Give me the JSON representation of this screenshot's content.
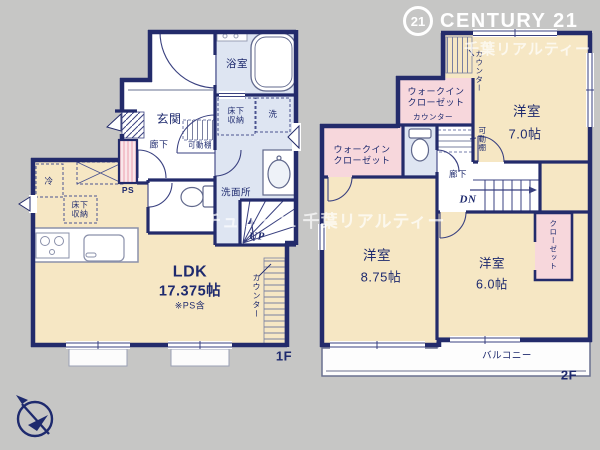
{
  "branding": {
    "badge": "21",
    "name": "CENTURY 21",
    "watermark_top": "千葉リアルティー",
    "watermark_center": "センチュリー21 千葉リアルティー"
  },
  "floor1": {
    "label": "1F",
    "ldk": {
      "name": "LDK",
      "size": "17.375帖",
      "note": "※PS含"
    },
    "genkan": "玄関",
    "bath": "浴室",
    "washroom": "洗面所",
    "corridor": "廊下",
    "movable_shelf": "可動棚",
    "storage_hall": "床下収納",
    "storage_ldk": "床下収納",
    "laundry": "洗",
    "fridge": "冷",
    "ps": "PS",
    "counter": "カウンター",
    "stairs_up": "UP"
  },
  "floor2": {
    "label": "2F",
    "room7": {
      "name": "洋室",
      "size": "7.0帖"
    },
    "room875": {
      "name": "洋室",
      "size": "8.75帖"
    },
    "room6": {
      "name": "洋室",
      "size": "6.0帖"
    },
    "wic_top": "ウォークインクローゼット",
    "wic_side": "ウォークインクローゼット",
    "counter_room7": "カウンター",
    "counter_wic": "カウンター",
    "movable_shelf": "可動棚",
    "closet": "クローゼット",
    "corridor": "廊下",
    "balcony": "バルコニー",
    "stairs_down": "DN"
  },
  "colors": {
    "background": "#c6c6c5",
    "wall": "#232b6b",
    "room_cream": "#f6e7c4",
    "wet_area_blue": "#dee5f2",
    "closet_pink": "#f7d7dc",
    "watermark": "#ffffff"
  }
}
